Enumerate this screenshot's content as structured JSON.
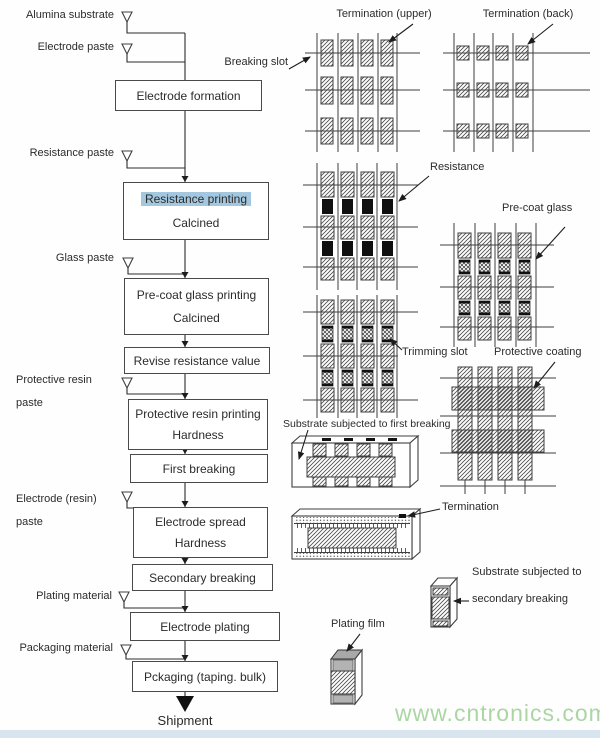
{
  "colors": {
    "highlight": "#a3c7de",
    "watermark": "#abd6a4",
    "bottom_strip": "#d9e5ee",
    "line": "#3f3f3f"
  },
  "inputs": {
    "alumina": "Alumina substrate",
    "electrode_paste": "Electrode paste",
    "resistance_paste": "Resistance paste",
    "glass_paste": "Glass paste",
    "protective_resin_paste": "Protective resin paste",
    "electrode_resin_paste": "Electrode (resin) paste",
    "plating_material": "Plating material",
    "packaging_material": "Packaging material"
  },
  "process": {
    "electrode_formation": "Electrode formation",
    "resistance_printing": "Resistance printing",
    "resistance_printing_sub": "Calcined",
    "precoat_glass_printing": "Pre-coat glass printing",
    "precoat_glass_printing_sub": "Calcined",
    "revise_resistance": "Revise resistance value",
    "protective_resin_printing": "Protective resin printing",
    "protective_resin_printing_sub": "Hardness",
    "first_breaking": "First breaking",
    "electrode_spread": "Electrode spread",
    "electrode_spread_sub": "Hardness",
    "secondary_breaking": "Secondary breaking",
    "electrode_plating": "Electrode plating",
    "packaging": "Pckaging (taping. bulk)",
    "shipment": "Shipment"
  },
  "annotations": {
    "termination_upper": "Termination (upper)",
    "termination_back": "Termination (back)",
    "breaking_slot": "Breaking slot",
    "resistance": "Resistance",
    "precoat_glass": "Pre-coat glass",
    "trimming_slot": "Trimming slot",
    "protective_coating": "Protective coating",
    "substrate_first_breaking": "Substrate subjected to first breaking",
    "termination": "Termination",
    "substrate_secondary_l1": "Substrate subjected to",
    "substrate_secondary_l2": "secondary breaking",
    "plating_film": "Plating film"
  },
  "watermark": "www.cntronics.com"
}
